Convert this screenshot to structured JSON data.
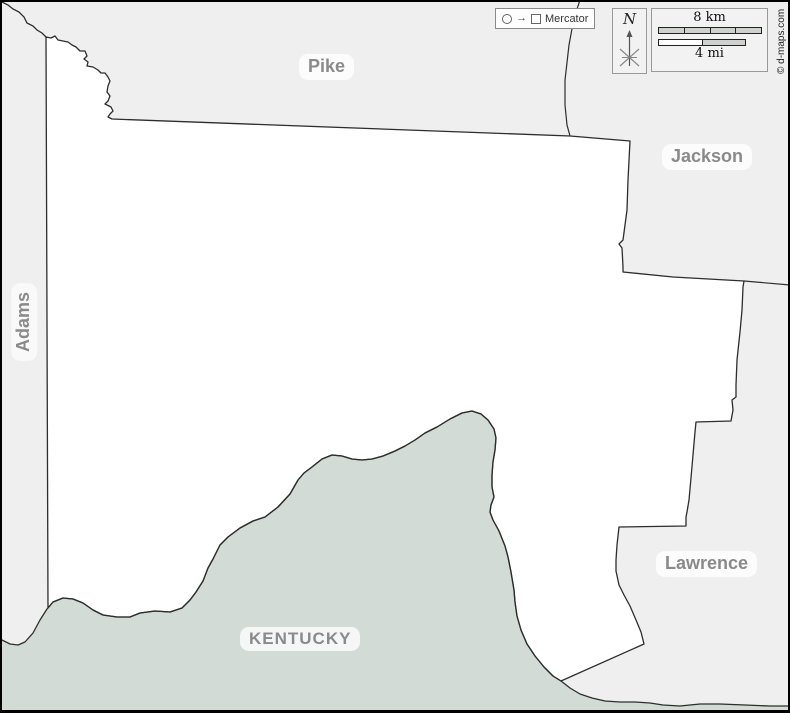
{
  "map": {
    "projection_label": "Mercator",
    "copyright": "© d-maps.com",
    "compass": {
      "north_label": "N"
    },
    "scale": {
      "km_label": "8 km",
      "mi_label": "4 mi"
    },
    "labels": {
      "pike": "Pike",
      "jackson": "Jackson",
      "adams": "Adams",
      "lawrence": "Lawrence",
      "kentucky": "KENTUCKY"
    },
    "colors": {
      "neighbor_fill": "#efefef",
      "county_fill": "#ffffff",
      "kentucky_fill": "#d3dbd6",
      "boundary": "#2d2d2d",
      "label_text": "#8a8a8a",
      "frame": "#000000"
    },
    "paths": {
      "kentucky": "M0,639 L10,644 18,645 25,642 33,633 40,620 47,609 53,602 63,598 73,599 83,603 93,610 103,615 117,617 130,617 140,613 155,611 170,612 182,608 190,600 196,592 203,581 208,568 213,559 220,545 228,537 240,528 253,521 265,517 278,507 290,494 298,480 304,473 312,467 322,459 332,455 342,456 352,459 362,460 372,459 383,456 395,451 405,446 415,440 425,433 437,427 450,419 462,413 472,411 481,414 488,420 494,429 496,438 495,450 493,462 492,475 492,487 494,497 491,505 490,512 493,520 499,531 505,546 508,557 511,572 514,590 515,602 517,616 521,630 527,644 535,656 544,667 553,676 561,681 570,688 580,694 592,698 605,701 620,702 635,702 650,703 663,705 680,706 700,704 720,704 745,705 770,706 790,706 L790,713 0,713 Z",
      "river": "M0,639 L10,644 18,645 25,642 33,633 40,620 47,609 53,602 63,598 73,599 83,603 93,610 103,615 117,617 130,617 140,613 155,611 170,612 182,608 190,600 196,592 203,581 208,568 213,559 220,545 228,537 240,528 253,521 265,517 278,507 290,494 298,480 304,473 312,467 322,459 332,455 342,456 352,459 362,460 372,459 383,456 395,451 405,446 415,440 425,433 437,427 450,419 462,413 472,411 481,414 488,420 494,429 496,438 495,450 493,462 492,475 492,487 494,497 491,505 490,512 493,520 499,531 505,546 508,557 511,572 514,590 515,602 517,616 521,630 527,644 535,656 544,667 553,676 561,681 570,688 580,694 592,698 605,701 620,702 635,702 650,703 663,705 680,706 700,704 720,704 745,705 770,706 790,706",
      "county": "M46,37 L51,38 55,36 58,40 63,41 68,42 72,45 76,47 80,51 85,51 87,56 84,59 88,62 87,66 93,67 98,70 101,73 105,73 108,77 110,81 108,86 107,92 110,96 108,101 105,104 111,107 113,111 110,114 108,117 112,119 570,136 630,141 628,180 627,210 623,240 619,244 622,248 623,267 623,272 673,277 744,281 743,287 742,310 740,332 737,360 736,385 736,397 732,400 733,410 731,421 696,422 695,432 693,455 691,478 689,500 687,512 686,517 686,526 619,527 617,545 616,560 616,571 619,585 624,595 630,606 636,620 641,632 644,644 561,681 553,676 544,667 535,656 527,644 521,630 517,616 515,602 514,590 511,572 508,557 505,546 499,531 493,520 490,512 491,505 494,497 492,487 492,475 493,462 495,450 496,438 494,429 488,420 481,414 472,411 462,413 450,419 437,427 425,433 415,440 405,446 395,451 383,456 372,459 362,460 352,459 342,456 332,455 322,459 312,467 304,473 298,480 290,494 278,507 265,517 253,521 240,528 228,537 220,545 213,559 208,568 203,581 196,592 190,600 182,608 170,612 155,611 140,613 130,617 117,617 103,615 93,610 83,603 73,599 63,598 53,602 48,608 Z",
      "adams_pike": "M0,1 L8,5 13,9 19,12 24,17 27,23 33,26 37,30 42,33 46,37",
      "pike_jackson": "M580,0 L574,18 569,45 565,80 565,105 567,125 570,136",
      "jackson_lawrence": "M744,281 L790,285"
    }
  }
}
